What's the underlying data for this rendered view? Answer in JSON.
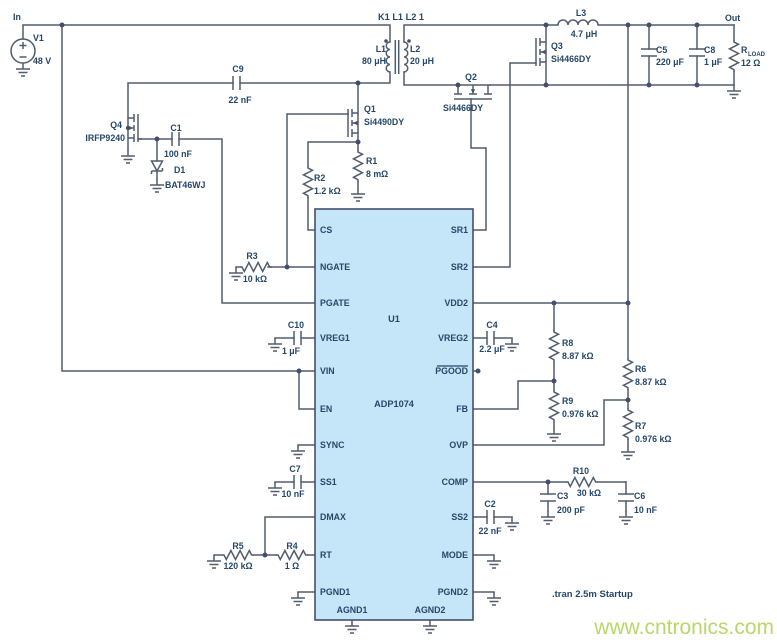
{
  "parts": {
    "in_label": "In",
    "out_label": "Out",
    "v1_ref": "V1",
    "v1_val": "48 V",
    "xfmr_label": "K1 L1 L2 1",
    "l1_ref": "L1",
    "l1_val": "80 μH",
    "l2_ref": "L2",
    "l2_val": "20 μH",
    "l3_ref": "L3",
    "l3_val": "4.7 μH",
    "q1_ref": "Q1",
    "q1_part": "Si4490DY",
    "q2_ref": "Q2",
    "q2_part": "Si4466DY",
    "q3_ref": "Q3",
    "q3_part": "Si4466DY",
    "q4_ref": "Q4",
    "q4_part": "IRFP9240",
    "d1_ref": "D1",
    "d1_part": "BAT46WJ",
    "r1_ref": "R1",
    "r1_val": "8 mΩ",
    "r2_ref": "R2",
    "r2_val": "1.2 kΩ",
    "r3_ref": "R3",
    "r3_val": "10 kΩ",
    "r4_ref": "R4",
    "r4_val": "1 Ω",
    "r5_ref": "R5",
    "r5_val": "120 kΩ",
    "r6_ref": "R6",
    "r6_val": "8.87 kΩ",
    "r7_ref": "R7",
    "r7_val": "0.976 kΩ",
    "r8_ref": "R8",
    "r8_val": "8.87 kΩ",
    "r9_ref": "R9",
    "r9_val": "0.976 kΩ",
    "r10_ref": "R10",
    "r10_val": "30 kΩ",
    "rload_ref": "R",
    "rload_sub": "LOAD",
    "rload_val": "12 Ω",
    "c1_ref": "C1",
    "c1_val": "100 nF",
    "c2_ref": "C2",
    "c2_val": "22 nF",
    "c3_ref": "C3",
    "c3_val": "200 pF",
    "c4_ref": "C4",
    "c4_val": "2.2 μF",
    "c5_ref": "C5",
    "c5_val": "220 μF",
    "c6_ref": "C6",
    "c6_val": "10 nF",
    "c7_ref": "C7",
    "c7_val": "10 nF",
    "c8_ref": "C8",
    "c8_val": "1 μF",
    "c9_ref": "C9",
    "c9_val": "22 nF",
    "c10_ref": "C10",
    "c10_val": "1 μF"
  },
  "ic": {
    "ref": "U1",
    "part": "ADP1074",
    "left_pins": [
      "CS",
      "NGATE",
      "PGATE",
      "VREG1",
      "VIN",
      "EN",
      "SYNC",
      "SS1",
      "DMAX",
      "RT",
      "PGND1"
    ],
    "right_pins": [
      "SR1",
      "SR2",
      "VDD2",
      "VREG2",
      "PGOOD",
      "FB",
      "OVP",
      "COMP",
      "SS2",
      "MODE",
      "PGND2"
    ],
    "bottom_pins": [
      "AGND1",
      "AGND2"
    ]
  },
  "annotations": {
    "spice_directive": ".tran 2.5m Startup",
    "watermark": "www.cntronics.com"
  },
  "colors": {
    "wire": "#515d6d",
    "label": "#25476a",
    "ic_fill": "#c5e5f8",
    "ic_border": "#44506b",
    "watermark_green": "#a3ce3f"
  }
}
